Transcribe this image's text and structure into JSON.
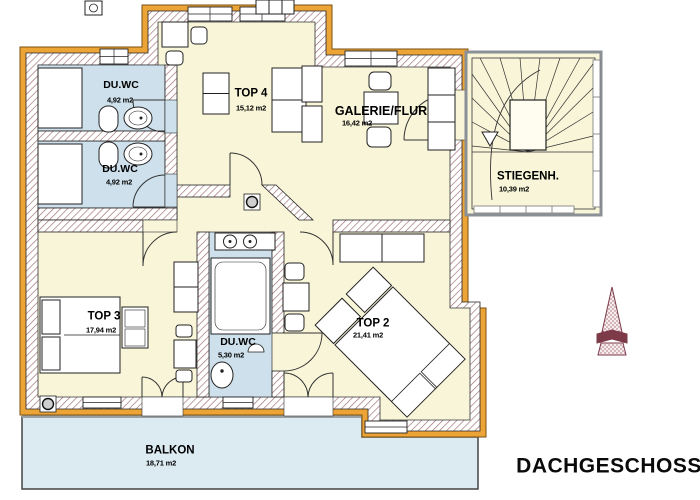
{
  "title": "DACHGESCHOSS",
  "rooms": [
    {
      "id": "duwc-1",
      "name": "DU.WC",
      "area": "4,92 m2"
    },
    {
      "id": "duwc-2",
      "name": "DU.WC",
      "area": "4,92 m2"
    },
    {
      "id": "top4",
      "name": "TOP 4",
      "area": "15,12 m2"
    },
    {
      "id": "galerie",
      "name": "GALERIE/FLUR",
      "area": "16,42 m2"
    },
    {
      "id": "stiegenh",
      "name": "STIEGENH.",
      "area": "10,39 m2"
    },
    {
      "id": "top3",
      "name": "TOP 3",
      "area": "17,94 m2"
    },
    {
      "id": "duwc-3",
      "name": "DU.WC",
      "area": "5,30 m2"
    },
    {
      "id": "top2",
      "name": "TOP 2",
      "area": "21,41 m2"
    },
    {
      "id": "balkon",
      "name": "BALKON",
      "area": "18,71 m2"
    }
  ],
  "colors": {
    "room_fill": "#f8f5d8",
    "bath_fill": "#cde0eb",
    "balcony_fill": "#dcebf2",
    "wall_hatch": "#9c6b6b",
    "facade_band": "#eda437",
    "outline": "#1a1a1a",
    "stair_frame": "#8a9096",
    "spire_red": "#7d3a49"
  }
}
